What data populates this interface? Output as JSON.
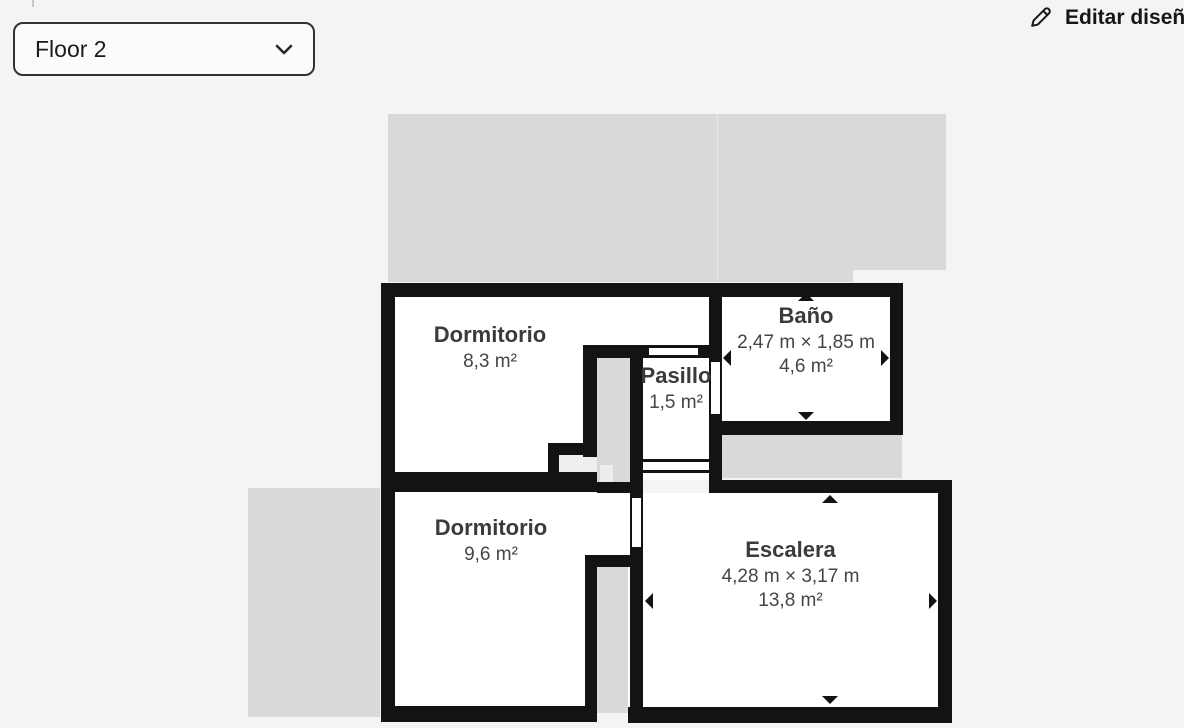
{
  "floor_selector": {
    "value": "Floor 2",
    "icon": "chevron-down"
  },
  "actions": {
    "edit_design": {
      "label": "Editar diseño",
      "icon": "pencil"
    }
  },
  "rooms": [
    {
      "id": "dormitorio-1",
      "name": "Dormitorio",
      "area": "8,3 m²"
    },
    {
      "id": "bano",
      "name": "Baño",
      "dimensions": "2,47 m × 1,85 m",
      "area": "4,6 m²",
      "resize_handles": [
        "up",
        "down",
        "left",
        "right"
      ]
    },
    {
      "id": "pasillo",
      "name": "Pasillo",
      "area": "1,5 m²"
    },
    {
      "id": "dormitorio-2",
      "name": "Dormitorio",
      "area": "9,6 m²"
    },
    {
      "id": "escalera",
      "name": "Escalera",
      "dimensions": "4,28 m × 3,17 m",
      "area": "13,8 m²",
      "resize_handles": [
        "up",
        "down",
        "left",
        "right"
      ]
    }
  ],
  "colors": {
    "background": "#f5f4f2",
    "wall": "#131312",
    "room_fill": "#ffffff",
    "slab_fill": "#d9d9d9",
    "text_primary": "#3d3b38",
    "text_secondary": "#474543"
  }
}
